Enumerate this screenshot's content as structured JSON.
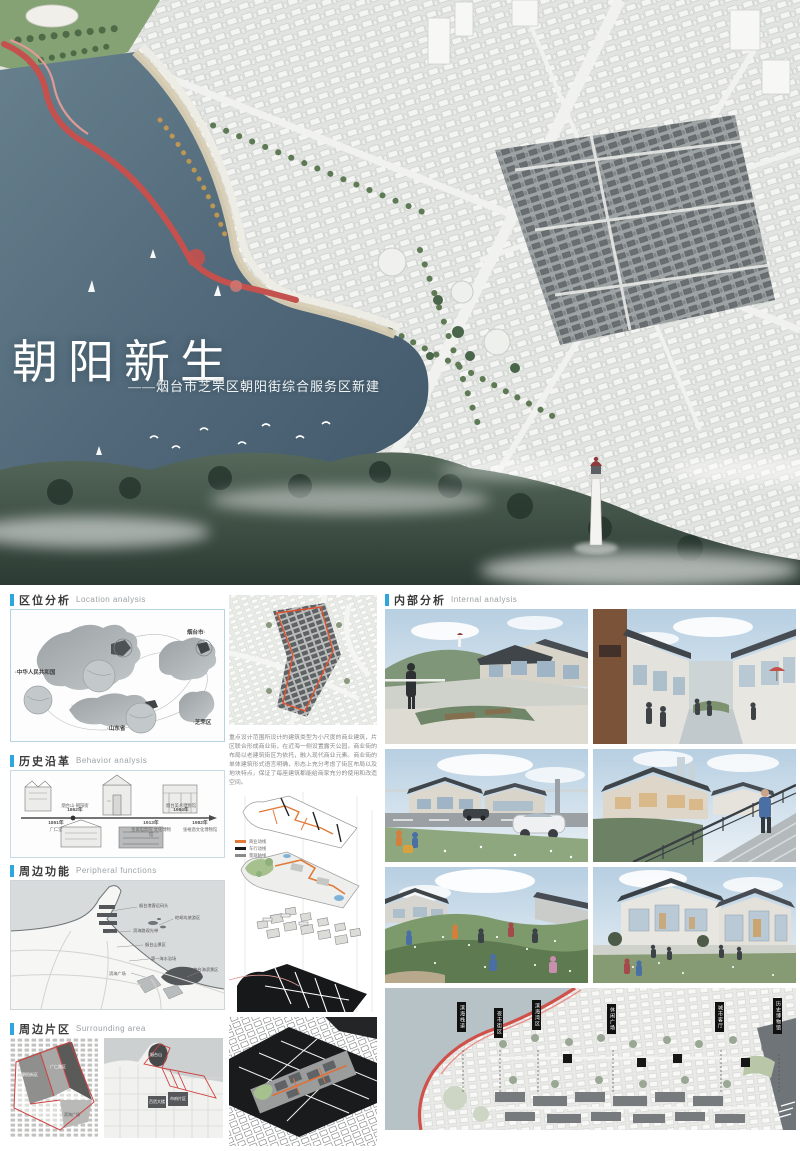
{
  "hero": {
    "title": "朝阳新生",
    "subtitle": "——烟台市芝罘区朝阳街综合服务区新建"
  },
  "sections": {
    "location": {
      "zh": "区位分析",
      "en": "Location analysis",
      "labels": {
        "china": "·中华人民共和国",
        "yantai": "烟台市·",
        "shandong": "·山东省",
        "zhifu": "·芝罘区"
      }
    },
    "history": {
      "zh": "历史沿革",
      "en": "Behavior analysis",
      "timeline": [
        {
          "year": "1851年",
          "name": "广仁堂"
        },
        {
          "year": "1862年",
          "name": "烟台山·朝阳街"
        },
        {
          "year": "1913年",
          "name": "金城电影院 文化博物馆"
        },
        {
          "year": "1984年",
          "name": "烟台美术博物馆"
        },
        {
          "year": "1982年",
          "name": "张裕酒文化博物馆"
        }
      ]
    },
    "functions": {
      "zh": "周边功能",
      "en": "Peripheral functions",
      "labels": [
        "烟台港客运码头",
        "崆峒岛旅游区",
        "滨海路观光带",
        "烟台山景区",
        "第一海水浴场",
        "滨海广场",
        "东炮台海滨景区"
      ]
    },
    "surrounding": {
      "zh": "周边片区",
      "en": "Surrounding area",
      "left_labels": [
        "朝阳街区",
        "广仁路区",
        "滨海广场"
      ],
      "right_labels": [
        "烟台山",
        "百货大楼",
        "市府片区"
      ]
    },
    "internal": {
      "zh": "内部分析",
      "en": "Internal analysis"
    }
  },
  "middle": {
    "description": "重点设计范围所设计的建筑类型为小尺度的商业建筑，片区联合形成商业街，在近海一侧设置露天公园，商业街的布局以老建筑街区为依托，融入现代商业元素。商业街的单体建筑形式语言明确，形态上充分考虑了街区布局以及地块特点，保证了每座建筑都能给商家充分的使用和改造空间。",
    "legend": [
      "商业动线",
      "车行动线",
      "景观轴线"
    ]
  },
  "model_tags": [
    "滨海栈道",
    "夜市街区",
    "滨海湾区",
    "休闲广场",
    "城市客厅",
    "历史博物馆"
  ],
  "colors": {
    "accent": "#2ea7e0",
    "ribbon": "#c9504d",
    "highlight_orange": "#e07b3a"
  }
}
